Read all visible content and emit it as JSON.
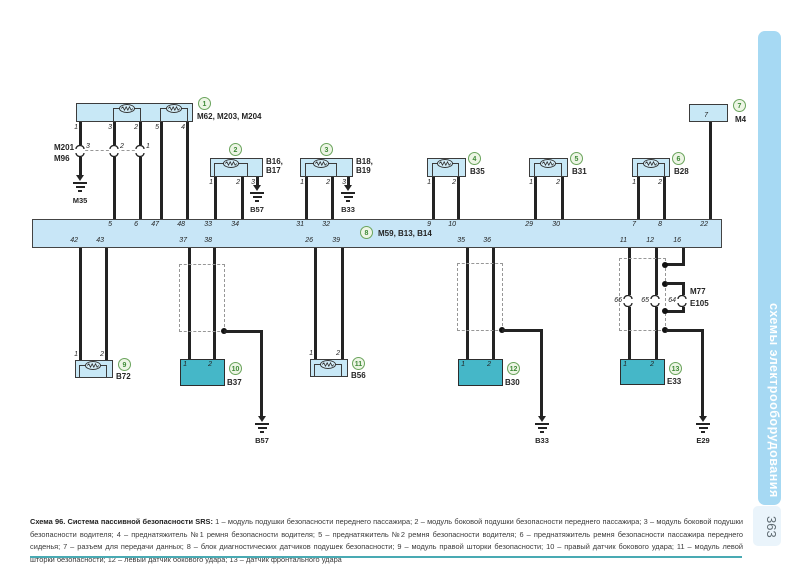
{
  "page": {
    "number": "363",
    "sidebar_text": "схемы электрооборудования"
  },
  "caption": {
    "title": "Схема 96. Система пассивной безопасности SRS:",
    "body": " 1 – модуль подушки безопасности переднего пассажира; 2 – модуль боковой подушки безопасности переднего пассажира; 3 – модуль боковой подушки безопасности водителя; 4 – преднатяжитель №1 ремня безопасности водителя; 5 – преднатяжитель №2 ремня безопасности водителя; 6 – преднатяжитель ремня безопасности пассажира переднего сиденья; 7 – разъем для передачи данных; 8 – блок диагностических датчиков подушек безопасности; 9 – модуль правой шторки безопасности; 10 – правый датчик бокового удара; 11 – модуль левой шторки безопасности; 12 – левый датчик бокового удара; 13 – датчик фронтального удара",
    "colors": {
      "rule": "#49aab3"
    }
  },
  "bus": {
    "num": "8",
    "name": "M59, B13, B14",
    "top_pins": [
      "5",
      "6",
      "47",
      "48",
      "33",
      "34",
      "31",
      "32",
      "9",
      "10",
      "29",
      "30",
      "7",
      "8",
      "22"
    ],
    "bottom_pins": [
      "42",
      "43",
      "37",
      "38",
      "26",
      "39",
      "35",
      "36",
      "11",
      "12",
      "16"
    ]
  },
  "components": {
    "c1": {
      "num": "1",
      "name": "M62, M203, M204",
      "pins": [
        "1",
        "3",
        "2",
        "5",
        "4"
      ]
    },
    "c2": {
      "num": "2",
      "name": "B16,\nB17",
      "pins": [
        "1",
        "2",
        "3"
      ]
    },
    "c3": {
      "num": "3",
      "name": "B18,\nB19",
      "pins": [
        "1",
        "2",
        "3"
      ]
    },
    "c4": {
      "num": "4",
      "name": "B35",
      "pins": [
        "1",
        "2"
      ]
    },
    "c5": {
      "num": "5",
      "name": "B31",
      "pins": [
        "1",
        "2"
      ]
    },
    "c6": {
      "num": "6",
      "name": "B28",
      "pins": [
        "1",
        "2"
      ]
    },
    "c7": {
      "num": "7",
      "name": "M4",
      "pins": [
        "7"
      ]
    },
    "c9": {
      "num": "9",
      "name": "B72",
      "pins": [
        "1",
        "2"
      ]
    },
    "c10": {
      "num": "10",
      "name": "B37",
      "pins": [
        "1",
        "2"
      ]
    },
    "c11": {
      "num": "11",
      "name": "B56",
      "pins": [
        "1",
        "2"
      ]
    },
    "c12": {
      "num": "12",
      "name": "B30",
      "pins": [
        "1",
        "2"
      ]
    },
    "c13": {
      "num": "13",
      "name": "E33",
      "pins": [
        "1",
        "2"
      ]
    }
  },
  "connectors": {
    "m201": {
      "label1": "M201",
      "label2": "M96",
      "pins": [
        "3",
        "2",
        "1"
      ]
    },
    "m77": {
      "label1": "M77",
      "label2": "E105",
      "pins": [
        "66",
        "65",
        "64"
      ]
    }
  },
  "grounds": {
    "m35": "M35",
    "b57_top": "B57",
    "b33_top": "B33",
    "b57_bottom": "B57",
    "b33_bottom": "B33",
    "e29": "E29"
  },
  "colors": {
    "light_box": "#c8e8f6",
    "teal_box": "#45b7c8",
    "bus_fill": "#c8e6f7",
    "sidebar": "#a6d9f3",
    "circle_green": "#3e8a37",
    "wire": "#232323"
  }
}
